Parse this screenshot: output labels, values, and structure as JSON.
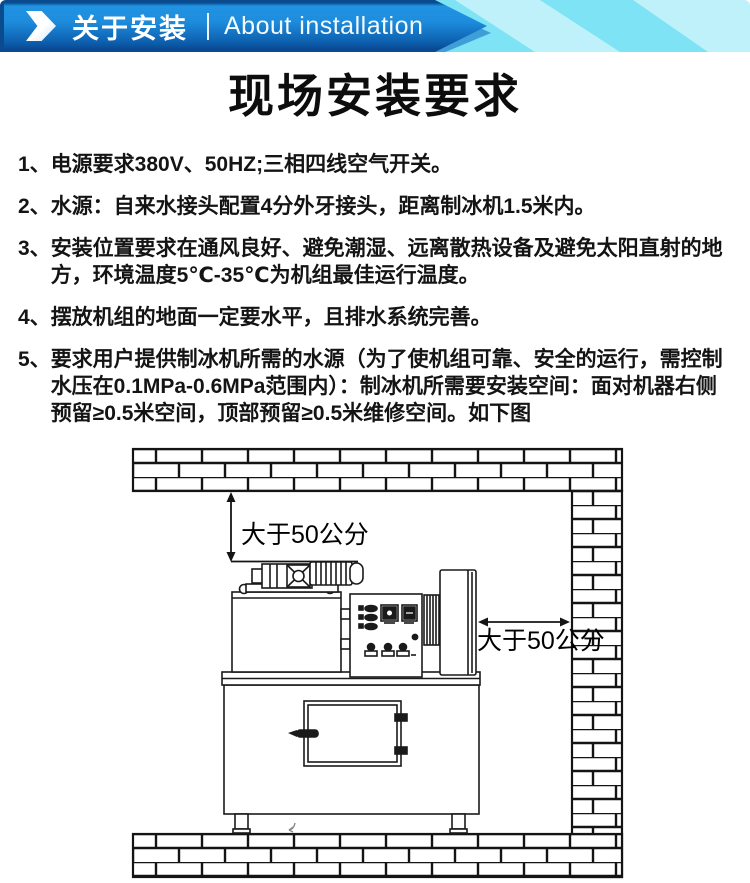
{
  "banner": {
    "title_zh": "关于安装",
    "title_en": "About installation"
  },
  "page": {
    "title": "现场安装要求"
  },
  "requirements": [
    {
      "num": "1、",
      "text": "电源要求380V、50HZ;三相四线空气开关。"
    },
    {
      "num": "2、",
      "text": "水源：自来水接头配置4分外牙接头，距离制冰机1.5米内。"
    },
    {
      "num": "3、",
      "text": "安装位置要求在通风良好、避免潮湿、远离散热设备及避免太阳直射的地方，环境温度5℃-35℃为机组最佳运行温度。"
    },
    {
      "num": "4、",
      "text": "摆放机组的地面一定要水平，且排水系统完善。"
    },
    {
      "num": "5、",
      "text": "要求用户提供制冰机所需的水源（为了使机组可靠、安全的运行，需控制水压在0.1MPa-0.6MPa范围内）：制冰机所需要安装空间：面对机器右侧预留≥0.5米空间，顶部预留≥0.5米维修空间。如下图"
    }
  ],
  "diagram": {
    "clearance_top_label": "大于50公分",
    "clearance_right_label": "大于50公分"
  },
  "colors": {
    "banner_blue_top": "#2093e2",
    "banner_blue_bottom": "#0b55a2",
    "banner_navy_edge": "#0a4a8e",
    "banner_mid_blue": "#3e9ed8",
    "banner_cyan": "#7de3f5",
    "banner_cyan_light": "#c2f0f9",
    "text_color": "#141414",
    "diagram_line": "#141414"
  }
}
